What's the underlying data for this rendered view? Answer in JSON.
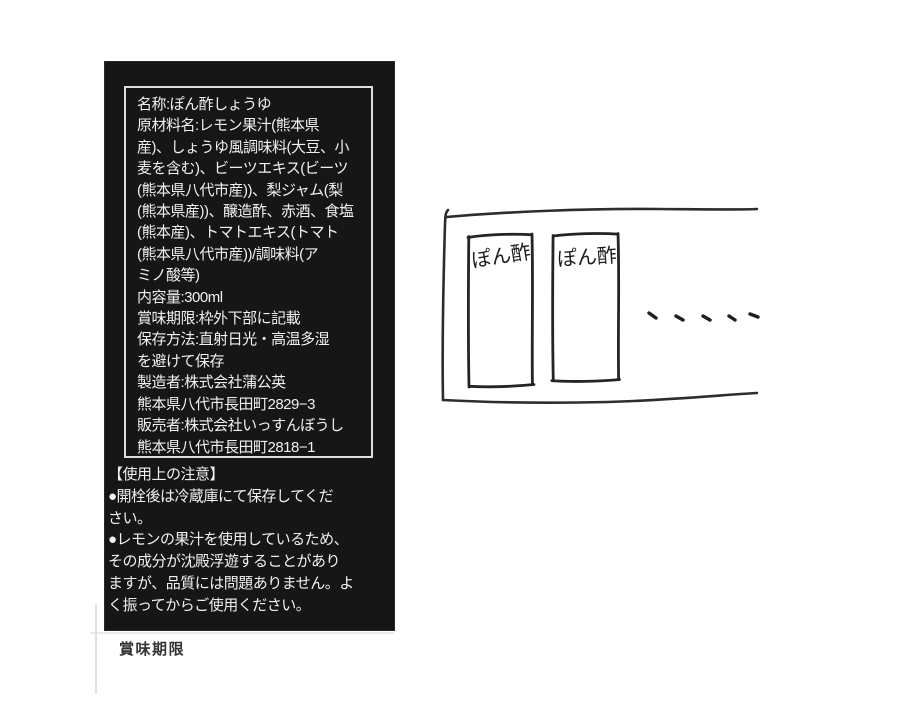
{
  "colors": {
    "page_bg": "#ffffff",
    "label_bg": "#161616",
    "label_text": "#f0f0f0",
    "inner_border": "#dedede",
    "expiry_text": "#333333",
    "sketch_ink": "#2d2d2d"
  },
  "info_box": {
    "lines": [
      "名称:ぽん酢しょうゆ",
      "原材料名:レモン果汁(熊本県",
      "産)、しょうゆ風調味料(大豆、小",
      "麦を含む)、ビーツエキス(ビーツ",
      "(熊本県八代市産))、梨ジャム(梨",
      "(熊本県産))、醸造酢、赤酒、食塩",
      "(熊本産)、トマトエキス(トマト",
      "(熊本県八代市産))/調味料(ア",
      "ミノ酸等)",
      "内容量:300ml",
      "賞味期限:枠外下部に記載",
      "保存方法:直射日光・高温多湿",
      "を避けて保存",
      "製造者:株式会社蒲公英",
      "熊本県八代市長田町2829−3",
      "販売者:株式会社いっすんぼうし",
      "熊本県八代市長田町2818−1"
    ]
  },
  "caution": {
    "lines": [
      "【使用上の注意】",
      "●開栓後は冷蔵庫にて保存してくだ",
      "さい。",
      "●レモンの果汁を使用しているため、",
      "その成分が沈殿浮遊することがあり",
      "ますが、品質には問題ありません。よ",
      "く振ってからご使用ください。"
    ]
  },
  "expiry_section": {
    "label": "賞味期限"
  },
  "sketch": {
    "bottle1_label": "ぽん酢",
    "bottle2_label": "ぽん酢"
  }
}
